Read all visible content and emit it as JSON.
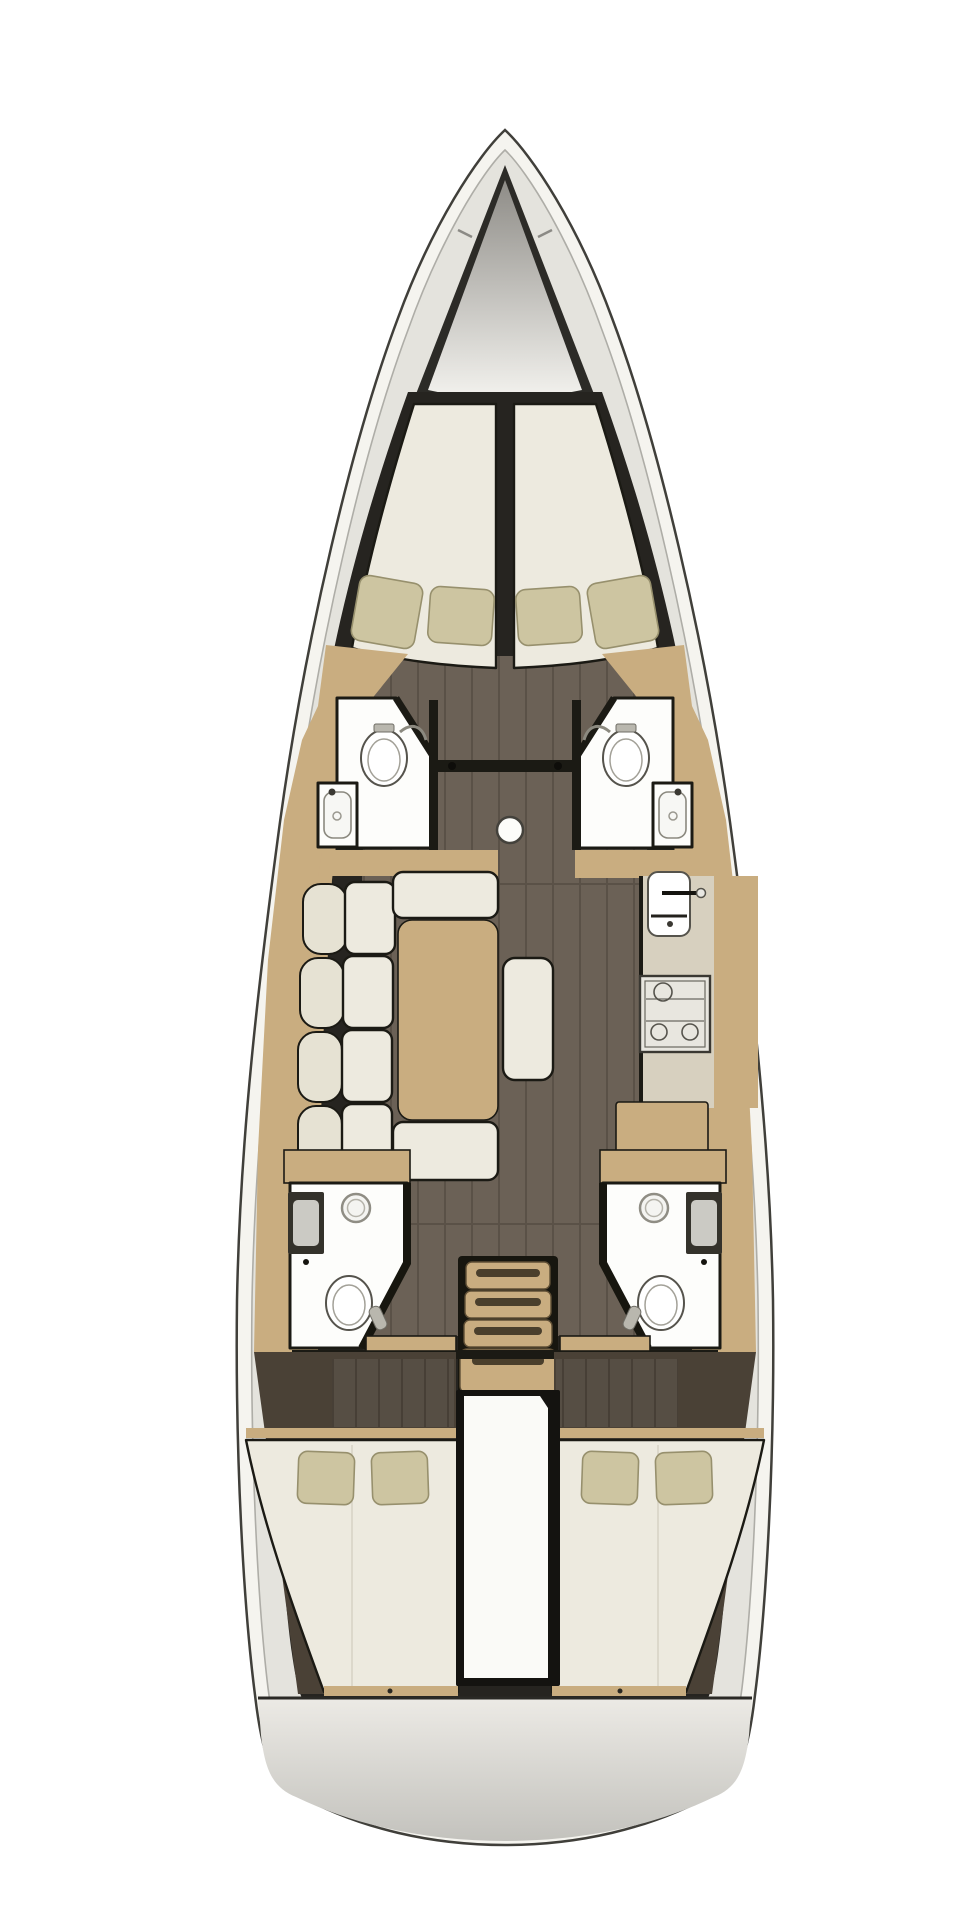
{
  "title": "Sailing yacht interior layout floor plan (top view)",
  "canvas": {
    "width": 959,
    "height": 1919,
    "background": "#ffffff"
  },
  "colors": {
    "hull_fill": "#f5f4ef",
    "hull_stroke": "#403f3a",
    "inner_wall": "#e4e3dd",
    "inner_wall_stroke": "#aeada7",
    "backdrop_dark": "#262420",
    "floor": "#6b6156",
    "floor_line": "#5a5147",
    "floor_aft": "#564e44",
    "aft_surround": "#4a4136",
    "wood": "#c9ad80",
    "cushion": "#edeadf",
    "cushion_backrest": "#e6e2d3",
    "pillow": "#cdc5a1",
    "pillow_stroke": "#97906d",
    "white_room": "#fdfdfb",
    "room_stroke": "#1b1a14",
    "fixture_stroke": "#55534c",
    "counter": "#d7d0bf",
    "stove_fill": "#e8e6df",
    "sink_dark": "#34322b",
    "sink_basin": "#cbcac4",
    "locker_top": "#8e8c87",
    "locker_bottom": "#f3f2ee",
    "transom_top": "#eceae5",
    "transom_bottom": "#c3c2bd"
  },
  "regions": [
    {
      "name": "anchor-locker",
      "fixtures": []
    },
    {
      "name": "forward-cabin",
      "fixtures": [
        "v-berth-port",
        "v-berth-starboard",
        "pillows-x4"
      ]
    },
    {
      "name": "forward-head-port",
      "fixtures": [
        "toilet",
        "washbasin"
      ]
    },
    {
      "name": "forward-head-starboard",
      "fixtures": [
        "toilet",
        "washbasin"
      ]
    },
    {
      "name": "saloon",
      "fixtures": [
        "settee-sofa",
        "dining-table",
        "ottoman-bench",
        "mast-post"
      ]
    },
    {
      "name": "galley",
      "fixtures": [
        "sink",
        "stove",
        "worktop",
        "chart-table"
      ]
    },
    {
      "name": "aft-head-port",
      "fixtures": [
        "shower",
        "washbasin",
        "toilet"
      ]
    },
    {
      "name": "aft-head-starboard",
      "fixtures": [
        "shower",
        "washbasin",
        "toilet"
      ]
    },
    {
      "name": "companionway",
      "fixtures": [
        "stairs-4-treads"
      ]
    },
    {
      "name": "engine-compartment",
      "fixtures": []
    },
    {
      "name": "aft-cabin-port",
      "fixtures": [
        "double-berth",
        "pillows-x2"
      ]
    },
    {
      "name": "aft-cabin-starboard",
      "fixtures": [
        "double-berth",
        "pillows-x2"
      ]
    },
    {
      "name": "transom",
      "fixtures": []
    }
  ]
}
